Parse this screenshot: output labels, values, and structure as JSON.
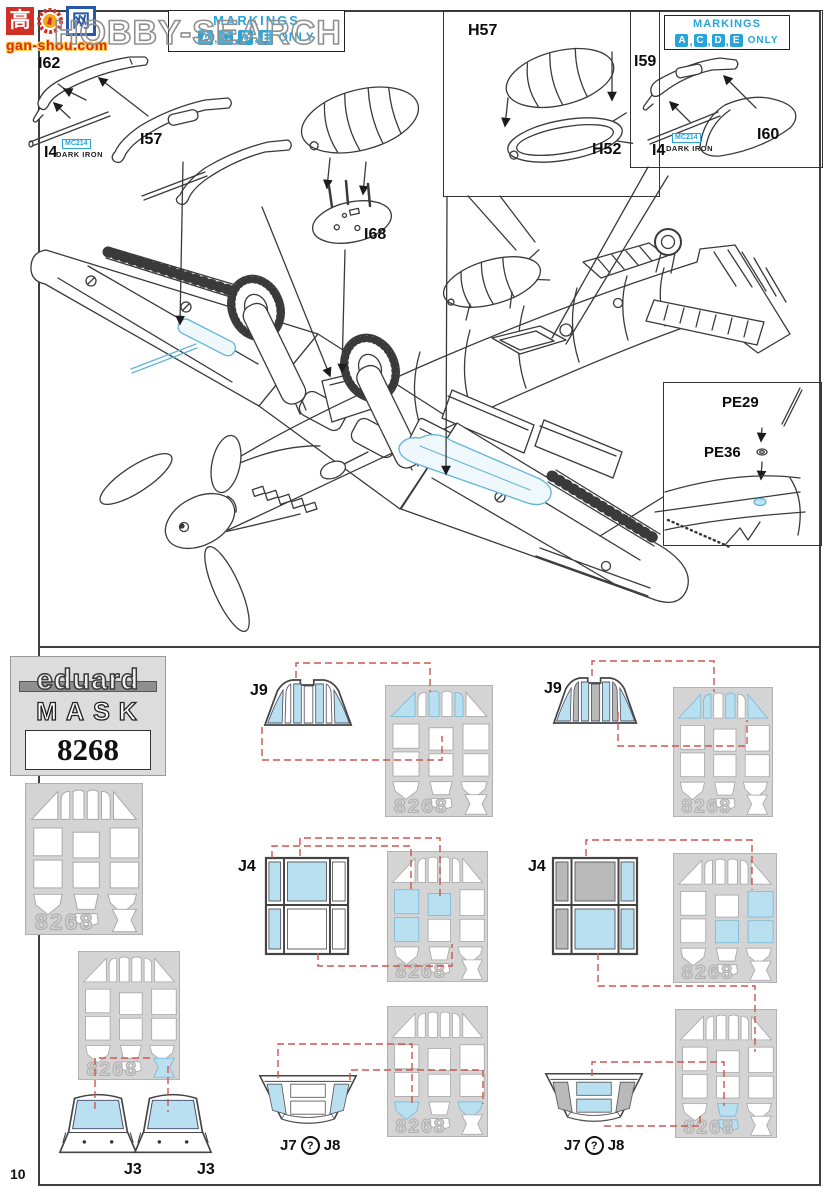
{
  "watermark": {
    "box1": "高",
    "box2": "网",
    "site": "gan-shou.com",
    "brand": "HOBBY-SEARCH"
  },
  "markings": {
    "title": "MARKINGS",
    "letters": [
      "A",
      "C",
      "D",
      "E"
    ],
    "separator": ",",
    "only": "ONLY"
  },
  "colors": {
    "cyan": "#29a4d9",
    "mask_blue": "#b9e0f1",
    "mask_blue_stroke": "#7db9d6",
    "pane_gray": "#b9b9b9",
    "pane_white": "#ffffff",
    "sheet_gray": "#d4d4d4",
    "cut_stroke": "#a8a8a8",
    "red_dash": "#cb564d",
    "ink": "#3a3a3a"
  },
  "labels": {
    "i62": "I62",
    "i57": "I57",
    "i4_left": "I4",
    "mc214_left": "MC214",
    "dark_iron_left": "DARK IRON",
    "h57": "H57",
    "h52": "H52",
    "i68": "I68",
    "i59": "I59",
    "i60": "I60",
    "i4_right": "I4",
    "mc214_right": "MC214",
    "dark_iron_right": "DARK IRON",
    "pe29": "PE29",
    "pe36": "PE36"
  },
  "mask_block": {
    "brand": "eduard",
    "product": "MASK",
    "number": "8268"
  },
  "sheet_number": "8268",
  "page": {
    "number": "10"
  },
  "sheets": [
    {
      "id": "sheet-reference",
      "x": 25,
      "y": 783,
      "w": 118,
      "h": 152,
      "highlights": []
    },
    {
      "id": "sheet-j9-left",
      "x": 385,
      "y": 685,
      "w": 108,
      "h": 132,
      "highlights": [
        "triL",
        "s2",
        "s4"
      ]
    },
    {
      "id": "sheet-j9-right",
      "x": 673,
      "y": 687,
      "w": 100,
      "h": 130,
      "highlights": [
        "triL",
        "s1",
        "s3",
        "triR"
      ]
    },
    {
      "id": "sheet-j4-left",
      "x": 387,
      "y": 851,
      "w": 101,
      "h": 131,
      "highlights": [
        "sqL1",
        "sqL2",
        "sqM1"
      ]
    },
    {
      "id": "sheet-j4-right",
      "x": 673,
      "y": 853,
      "w": 104,
      "h": 130,
      "highlights": [
        "sqR1",
        "sqR2",
        "sqM2"
      ]
    },
    {
      "id": "sheet-j3",
      "x": 78,
      "y": 951,
      "w": 102,
      "h": 129,
      "highlights": [
        "bowtie"
      ]
    },
    {
      "id": "sheet-j7j8-left",
      "x": 387,
      "y": 1006,
      "w": 101,
      "h": 131,
      "highlights": [
        "shieldL",
        "shieldR"
      ]
    },
    {
      "id": "sheet-j7j8-right",
      "x": 675,
      "y": 1009,
      "w": 102,
      "h": 129,
      "highlights": [
        "trapM1",
        "trapM2"
      ]
    }
  ],
  "steps": [
    {
      "id": "j9-left",
      "label": "J9",
      "lx": 250,
      "ly": 682,
      "part": "windscreen",
      "px": 263,
      "py": 676,
      "pw": 92,
      "ph": 52,
      "panes": [
        "blue",
        "white",
        "blue",
        "white",
        "blue",
        "white",
        "blue"
      ]
    },
    {
      "id": "j9-right",
      "label": "J9",
      "lx": 544,
      "ly": 680,
      "part": "windscreen",
      "px": 552,
      "py": 674,
      "pw": 88,
      "ph": 52,
      "panes": [
        "blue",
        "gray",
        "blue",
        "gray",
        "blue",
        "gray",
        "blue"
      ]
    },
    {
      "id": "j4-left",
      "label": "J4",
      "lx": 238,
      "ly": 858,
      "part": "window",
      "px": 264,
      "py": 856,
      "pw": 86,
      "ph": 100,
      "cells": [
        "blue",
        "blue",
        "blue",
        "white",
        "white",
        "white"
      ]
    },
    {
      "id": "j4-right",
      "label": "J4",
      "lx": 528,
      "ly": 858,
      "part": "window",
      "px": 551,
      "py": 856,
      "pw": 88,
      "ph": 100,
      "cells": [
        "gray",
        "gray",
        "gray",
        "blue",
        "blue",
        "blue"
      ]
    },
    {
      "id": "j3-a",
      "label": "J3",
      "lx": 124,
      "ly": 1161,
      "part": "j3",
      "px": 55,
      "py": 1088,
      "pw": 86,
      "ph": 70
    },
    {
      "id": "j3-b",
      "label": "J3",
      "lx": 197,
      "ly": 1161,
      "part": "j3",
      "px": 130,
      "py": 1088,
      "pw": 86,
      "ph": 70
    },
    {
      "id": "j7j8-left",
      "label7": "J7",
      "q": "?",
      "label8": "J8",
      "lx": 280,
      "ly": 1136,
      "part": "j7j8",
      "px": 258,
      "py": 1072,
      "pw": 100,
      "ph": 60,
      "variant": "sides"
    },
    {
      "id": "j7j8-right",
      "label7": "J7",
      "q": "?",
      "label8": "J8",
      "lx": 564,
      "ly": 1136,
      "part": "j7j8",
      "px": 544,
      "py": 1070,
      "pw": 100,
      "ph": 60,
      "variant": "center"
    }
  ],
  "connectors": [
    [
      [
        296,
        678
      ],
      [
        296,
        663
      ],
      [
        430,
        663
      ],
      [
        430,
        692
      ]
    ],
    [
      [
        262,
        727
      ],
      [
        262,
        760
      ],
      [
        442,
        760
      ],
      [
        442,
        736
      ]
    ],
    [
      [
        592,
        676
      ],
      [
        592,
        661
      ],
      [
        714,
        661
      ],
      [
        714,
        692
      ]
    ],
    [
      [
        618,
        712
      ],
      [
        618,
        746
      ],
      [
        747,
        746
      ],
      [
        747,
        720
      ]
    ],
    [
      [
        300,
        856
      ],
      [
        300,
        838
      ],
      [
        440,
        838
      ],
      [
        440,
        896
      ]
    ],
    [
      [
        272,
        858
      ],
      [
        272,
        846
      ],
      [
        411,
        846
      ],
      [
        411,
        893
      ]
    ],
    [
      [
        318,
        953
      ],
      [
        318,
        966
      ],
      [
        452,
        966
      ],
      [
        452,
        944
      ]
    ],
    [
      [
        586,
        856
      ],
      [
        586,
        840
      ],
      [
        752,
        840
      ],
      [
        752,
        890
      ]
    ],
    [
      [
        598,
        953
      ],
      [
        598,
        986
      ],
      [
        755,
        986
      ],
      [
        755,
        1052
      ]
    ],
    [
      [
        150,
        1058
      ],
      [
        95,
        1058
      ],
      [
        95,
        1112
      ]
    ],
    [
      [
        168,
        1066
      ],
      [
        168,
        1112
      ]
    ],
    [
      [
        278,
        1078
      ],
      [
        278,
        1044
      ],
      [
        412,
        1044
      ],
      [
        412,
        1104
      ]
    ],
    [
      [
        350,
        1080
      ],
      [
        350,
        1070
      ],
      [
        483,
        1070
      ],
      [
        483,
        1104
      ]
    ],
    [
      [
        592,
        1076
      ],
      [
        592,
        1062
      ],
      [
        724,
        1062
      ],
      [
        724,
        1106
      ]
    ],
    [
      [
        604,
        1126
      ],
      [
        700,
        1126
      ],
      [
        700,
        1114
      ]
    ]
  ]
}
